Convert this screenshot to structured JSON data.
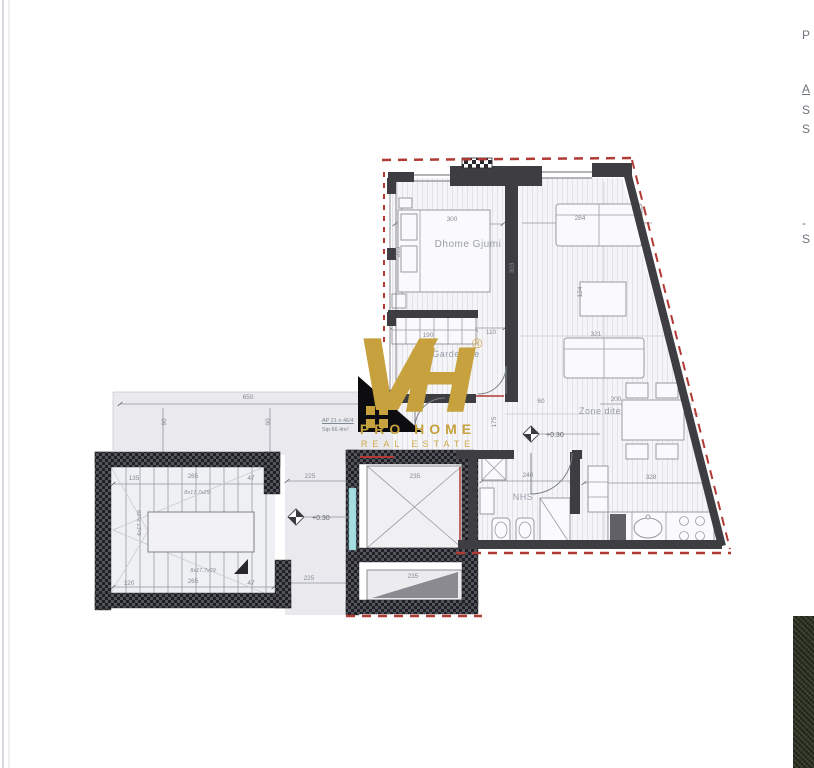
{
  "document": {
    "kind": "scanned apartment floor plan with real-estate watermark"
  },
  "watermark": {
    "letter_v": "V",
    "letter_h": "H",
    "registered_mark": "®",
    "brand_line1": "PRO HOME",
    "brand_line2": "REAL ESTATE",
    "gold": "#c6a13e"
  },
  "unit_label": {
    "line1": "AP 21 n 46/4",
    "line2": "Sip 66.4m²"
  },
  "side_panel": {
    "fragments": [
      {
        "t": "P",
        "y": 28,
        "u": false
      },
      {
        "t": "A",
        "y": 82,
        "u": true
      },
      {
        "t": "S",
        "y": 103,
        "u": false
      },
      {
        "t": "S",
        "y": 122,
        "u": false
      },
      {
        "t": "-",
        "y": 216,
        "u": false
      },
      {
        "t": "S",
        "y": 232,
        "u": false
      }
    ]
  },
  "plan": {
    "room_labels": [
      {
        "t": "Dhome Gjumi",
        "x": 468,
        "y": 247,
        "fs": 10
      },
      {
        "t": "Garderobe",
        "x": 456,
        "y": 357,
        "fs": 9
      },
      {
        "t": "Zone dite",
        "x": 600,
        "y": 414,
        "fs": 9
      },
      {
        "t": "NHS",
        "x": 523,
        "y": 500,
        "fs": 9
      }
    ],
    "elevation_labels": [
      {
        "t": "+0.30",
        "x": 546,
        "y": 437
      },
      {
        "t": "+0.30",
        "x": 312,
        "y": 520
      }
    ],
    "dimension_labels": [
      {
        "t": "300",
        "x": 452,
        "y": 221
      },
      {
        "t": "313",
        "x": 400,
        "y": 252,
        "r": -90
      },
      {
        "t": "303",
        "x": 514,
        "y": 268,
        "r": -90
      },
      {
        "t": "190",
        "x": 428,
        "y": 337
      },
      {
        "t": "110",
        "x": 491,
        "y": 334
      },
      {
        "t": "90",
        "x": 420,
        "y": 357
      },
      {
        "t": "284",
        "x": 580,
        "y": 220
      },
      {
        "t": "124",
        "x": 582,
        "y": 292,
        "r": -90
      },
      {
        "t": "321",
        "x": 596,
        "y": 336
      },
      {
        "t": "200",
        "x": 616,
        "y": 401
      },
      {
        "t": "175",
        "x": 496,
        "y": 422,
        "r": -90
      },
      {
        "t": "60",
        "x": 541,
        "y": 403
      },
      {
        "t": "240",
        "x": 528,
        "y": 477
      },
      {
        "t": "328",
        "x": 651,
        "y": 479
      },
      {
        "t": "650",
        "x": 248,
        "y": 399
      },
      {
        "t": "90",
        "x": 166,
        "y": 422,
        "r": -90
      },
      {
        "t": "90",
        "x": 270,
        "y": 422,
        "r": -90
      },
      {
        "t": "225",
        "x": 310,
        "y": 478
      },
      {
        "t": "225",
        "x": 309,
        "y": 580
      },
      {
        "t": "135",
        "x": 134,
        "y": 480
      },
      {
        "t": "265",
        "x": 193,
        "y": 478
      },
      {
        "t": "47",
        "x": 251,
        "y": 480
      },
      {
        "t": "120",
        "x": 129,
        "y": 585
      },
      {
        "t": "265",
        "x": 193,
        "y": 583
      },
      {
        "t": "47",
        "x": 251,
        "y": 585
      },
      {
        "t": "8x17.7x29",
        "x": 197,
        "y": 494,
        "fs": 5.5,
        "i": true
      },
      {
        "t": "8x17.7x29",
        "x": 203,
        "y": 572,
        "fs": 5.5,
        "i": true
      },
      {
        "t": "6x17.7x29",
        "x": 141,
        "y": 523,
        "r": -90,
        "fs": 5.5,
        "i": true
      },
      {
        "t": "235",
        "x": 415,
        "y": 478
      },
      {
        "t": "235",
        "x": 413,
        "y": 578
      }
    ]
  },
  "colors": {
    "wall_dark": "#3d3d42",
    "wall_hatch_dark": "#1f1f26",
    "boundary_red": "#b23a35",
    "floor_tint": "#f5f5f8",
    "corridor_gray": "#eaeaee",
    "glass_cyan": "#a5dde0",
    "dim_gray": "#868b93",
    "vegetation_dark": "#333a2b",
    "watermark_gold": "#c6a13e"
  }
}
